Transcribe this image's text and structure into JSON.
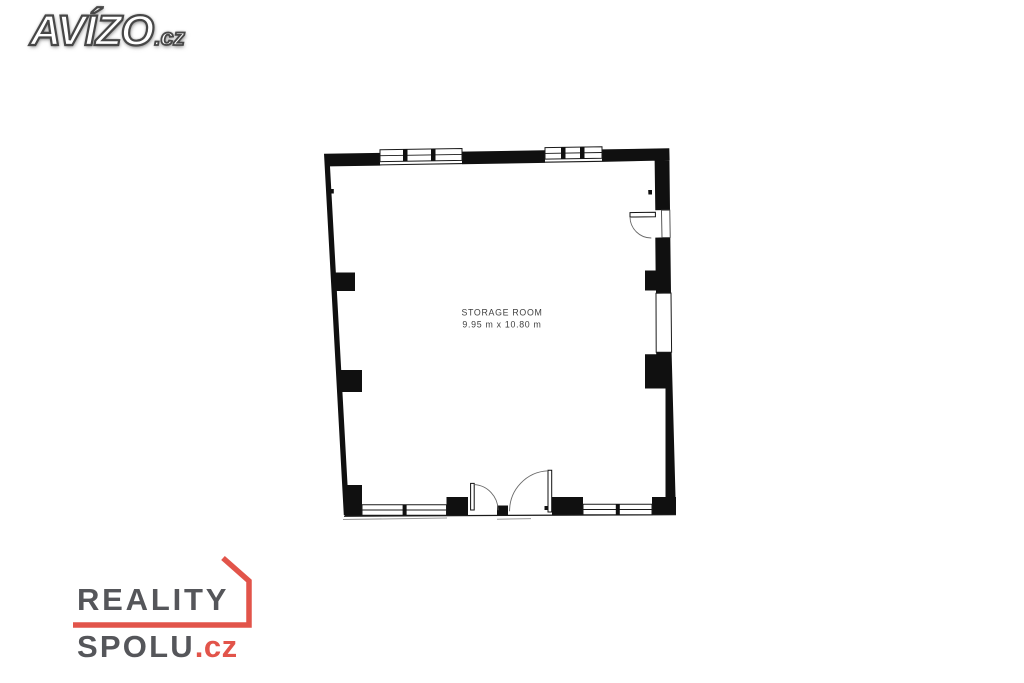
{
  "page": {
    "background_color": "#ffffff"
  },
  "avizo_logo": {
    "text": "AVÍZO",
    "suffix": ".cz",
    "fill_color": "#ffffff",
    "outline_color": "#474747"
  },
  "reality_spolu_logo": {
    "line1": "REALITY",
    "line2": "SPOLU",
    "suffix": ".cz",
    "text_color": "#55565a",
    "accent_color": "#e2544a"
  },
  "floor_plan": {
    "room_label": "STORAGE ROOM",
    "room_dimensions": "9.95 m x 10.80 m",
    "wall_color": "#101010",
    "line_color": "#1a1a1a",
    "label_color": "#414141",
    "swing_arc_color": "#6a6a6a"
  }
}
